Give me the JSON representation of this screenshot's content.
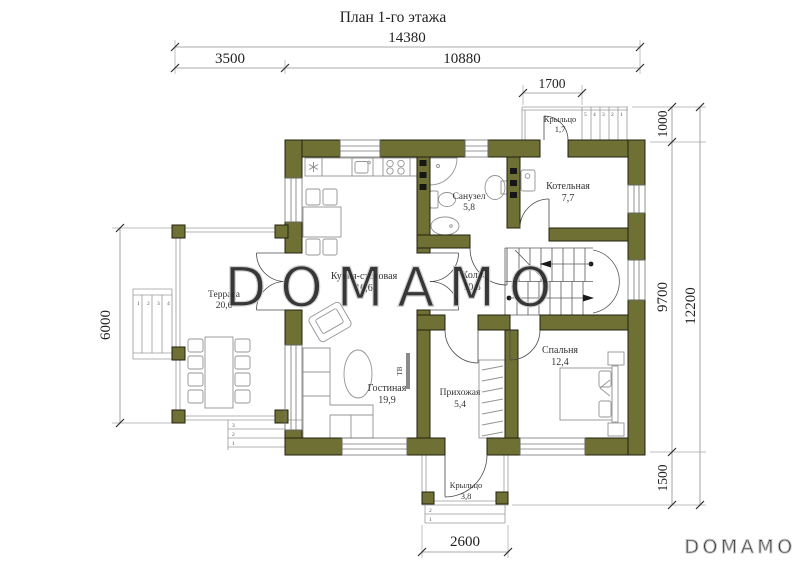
{
  "title": "План 1-го этажа",
  "watermark": {
    "center": "DOMAMO",
    "corner": "DOMAMO"
  },
  "colors": {
    "wall": "#6f7134",
    "wall_outline": "#20200f",
    "dimension_text": "#1f1f1f",
    "watermark": "#cdcdcd"
  },
  "rooms": {
    "kitchen": {
      "name": "Кухня-столовая",
      "area": "10,6"
    },
    "bathroom": {
      "name": "Санузел",
      "area": "5,8"
    },
    "boiler": {
      "name": "Котельная",
      "area": "7,7"
    },
    "hall": {
      "name": "Холл",
      "area": "10,8"
    },
    "terrace": {
      "name": "Терраса",
      "area": "20,6"
    },
    "living": {
      "name": "Гостиная",
      "area": "19,9"
    },
    "entry": {
      "name": "Прихожая",
      "area": "5,4"
    },
    "bedroom": {
      "name": "Спальня",
      "area": "12,4"
    },
    "porch_top": {
      "name": "Крыльцо",
      "area": "1,7"
    },
    "porch_bottom": {
      "name": "Крыльцо",
      "area": "3,8"
    }
  },
  "dimensions": {
    "total_width": "14380",
    "terrace_width": "3500",
    "house_width": "10880",
    "porch_top_width": "1700",
    "porch_top_depth": "1000",
    "house_depth": "9700",
    "total_depth": "12200",
    "porch_bottom_depth": "1500",
    "terrace_depth": "6000",
    "porch_bottom_width": "2600"
  },
  "labels": {
    "tv": "ТВ"
  },
  "step_numbers": {
    "porch_top": [
      "5",
      "4",
      "3",
      "2",
      "1"
    ],
    "terrace_left": [
      "1",
      "2",
      "3",
      "4"
    ],
    "terrace_bottom": [
      "3",
      "2",
      "1"
    ],
    "porch_bottom": [
      "2",
      "1"
    ]
  }
}
